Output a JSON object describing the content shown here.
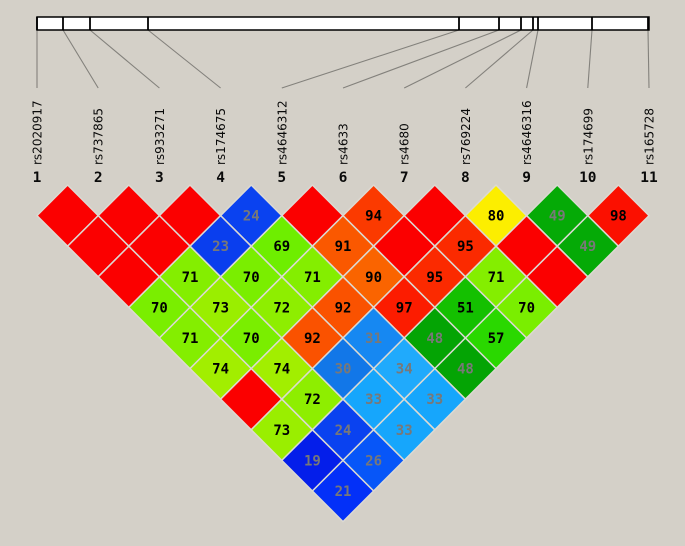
{
  "chart_data": {
    "type": "heatmap",
    "title": "",
    "description": "Haploview-style pairwise linkage disequilibrium (LD) triangle plot for 11 SNP markers; blank red diamonds represent LD value 100",
    "snps": [
      {
        "index": "1",
        "name": "rs2020917"
      },
      {
        "index": "2",
        "name": "rs737865"
      },
      {
        "index": "3",
        "name": "rs933271"
      },
      {
        "index": "4",
        "name": "rs174675"
      },
      {
        "index": "5",
        "name": "rs4646312"
      },
      {
        "index": "6",
        "name": "rs4633"
      },
      {
        "index": "7",
        "name": "rs4680"
      },
      {
        "index": "8",
        "name": "rs769224"
      },
      {
        "index": "9",
        "name": "rs4646316"
      },
      {
        "index": "10",
        "name": "rs174699"
      },
      {
        "index": "11",
        "name": "rs165728"
      }
    ],
    "ld_pairs": [
      {
        "i": 1,
        "j": 2,
        "v": 100
      },
      {
        "i": 2,
        "j": 3,
        "v": 100
      },
      {
        "i": 3,
        "j": 4,
        "v": 100
      },
      {
        "i": 4,
        "j": 5,
        "v": 24
      },
      {
        "i": 5,
        "j": 6,
        "v": 100
      },
      {
        "i": 6,
        "j": 7,
        "v": 94
      },
      {
        "i": 7,
        "j": 8,
        "v": 100
      },
      {
        "i": 8,
        "j": 9,
        "v": 80
      },
      {
        "i": 9,
        "j": 10,
        "v": 49
      },
      {
        "i": 10,
        "j": 11,
        "v": 98
      },
      {
        "i": 1,
        "j": 3,
        "v": 100
      },
      {
        "i": 2,
        "j": 4,
        "v": 100
      },
      {
        "i": 3,
        "j": 5,
        "v": 23
      },
      {
        "i": 4,
        "j": 6,
        "v": 69
      },
      {
        "i": 5,
        "j": 7,
        "v": 91
      },
      {
        "i": 6,
        "j": 8,
        "v": 100
      },
      {
        "i": 7,
        "j": 9,
        "v": 95
      },
      {
        "i": 8,
        "j": 10,
        "v": 100
      },
      {
        "i": 9,
        "j": 11,
        "v": 49
      },
      {
        "i": 1,
        "j": 4,
        "v": 100
      },
      {
        "i": 2,
        "j": 5,
        "v": 71
      },
      {
        "i": 3,
        "j": 6,
        "v": 70
      },
      {
        "i": 4,
        "j": 7,
        "v": 71
      },
      {
        "i": 5,
        "j": 8,
        "v": 90
      },
      {
        "i": 6,
        "j": 9,
        "v": 95
      },
      {
        "i": 7,
        "j": 10,
        "v": 71
      },
      {
        "i": 8,
        "j": 11,
        "v": 100
      },
      {
        "i": 1,
        "j": 5,
        "v": 70
      },
      {
        "i": 2,
        "j": 6,
        "v": 73
      },
      {
        "i": 3,
        "j": 7,
        "v": 72
      },
      {
        "i": 4,
        "j": 8,
        "v": 92
      },
      {
        "i": 5,
        "j": 9,
        "v": 97
      },
      {
        "i": 6,
        "j": 10,
        "v": 51
      },
      {
        "i": 7,
        "j": 11,
        "v": 70
      },
      {
        "i": 1,
        "j": 6,
        "v": 71
      },
      {
        "i": 2,
        "j": 7,
        "v": 70
      },
      {
        "i": 3,
        "j": 8,
        "v": 92
      },
      {
        "i": 4,
        "j": 9,
        "v": 31
      },
      {
        "i": 5,
        "j": 10,
        "v": 48
      },
      {
        "i": 6,
        "j": 11,
        "v": 57
      },
      {
        "i": 1,
        "j": 7,
        "v": 74
      },
      {
        "i": 2,
        "j": 8,
        "v": 74
      },
      {
        "i": 3,
        "j": 9,
        "v": 30
      },
      {
        "i": 4,
        "j": 10,
        "v": 34
      },
      {
        "i": 5,
        "j": 11,
        "v": 48
      },
      {
        "i": 1,
        "j": 8,
        "v": 100
      },
      {
        "i": 2,
        "j": 9,
        "v": 72
      },
      {
        "i": 3,
        "j": 10,
        "v": 33
      },
      {
        "i": 4,
        "j": 11,
        "v": 33
      },
      {
        "i": 1,
        "j": 9,
        "v": 73
      },
      {
        "i": 2,
        "j": 10,
        "v": 24
      },
      {
        "i": 3,
        "j": 11,
        "v": 33
      },
      {
        "i": 1,
        "j": 10,
        "v": 19
      },
      {
        "i": 2,
        "j": 11,
        "v": 26
      },
      {
        "i": 1,
        "j": 11,
        "v": 21
      }
    ],
    "blank_value": 100,
    "gray_text_below": 50,
    "palette": {
      "100": "#fb0000",
      "98": "#fb1000",
      "97": "#fc1c00",
      "95": "#fb2a00",
      "94": "#fb3a00",
      "92": "#fa5200",
      "91": "#fa5800",
      "90": "#fa6400",
      "80": "#fcee00",
      "74": "#a2ee00",
      "73": "#9aee00",
      "72": "#8eee00",
      "71": "#84ee00",
      "70": "#7aee00",
      "69": "#6eee00",
      "57": "#2ad800",
      "51": "#14c000",
      "49": "#05aa06",
      "48": "#04a404",
      "34": "#20aafc",
      "33": "#16a6fc",
      "31": "#1688f2",
      "30": "#1277e8",
      "26": "#0756f8",
      "24": "#0a42f0",
      "23": "#0a3eee",
      "21": "#0330f8",
      "19": "#041eea"
    },
    "layout": {
      "width": 685,
      "height": 546,
      "first_snp_x": 37,
      "snp_spacing": 61.2,
      "ruler": {
        "y": 17,
        "height": 13,
        "x1": 37,
        "x2": 649,
        "tick_x": [
          37,
          63,
          90,
          148,
          459,
          499,
          521,
          533,
          538,
          592,
          648
        ]
      },
      "connector_top_y": 30,
      "connector_bottom_y": 88,
      "label_baseline_y": 165,
      "index_baseline_y": 182,
      "triangle_top_y": 185,
      "cell_half": 30.6,
      "colors": {
        "background": "#d4d0c8",
        "ruler_fill": "#ffffff",
        "ruler_border": "#000000",
        "connector": "#83817c",
        "cell_gap": "#dcdad3",
        "label_text": "#0a0a0a",
        "value_black": "#000000",
        "value_gray": "#787878"
      }
    }
  }
}
